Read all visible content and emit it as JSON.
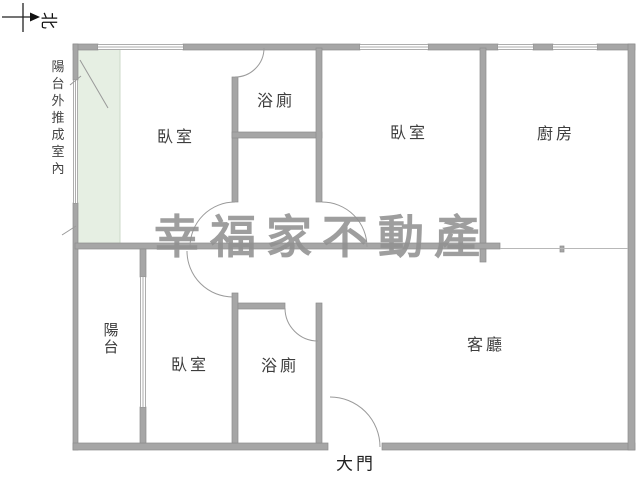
{
  "compass": {
    "north_label": "北"
  },
  "annotation": {
    "text": "陽台外推成室內"
  },
  "watermark": {
    "text": "幸福家不動產",
    "color": "#919191"
  },
  "rooms": {
    "bedroom_top_left": "臥室",
    "bathroom_top": "浴廁",
    "bedroom_top_right": "臥室",
    "kitchen": "廚房",
    "balcony": "陽台",
    "bedroom_bottom": "臥室",
    "bathroom_bottom": "浴廁",
    "living_room": "客廳",
    "main_door": "大門"
  },
  "colors": {
    "wall": "#a6a6a6",
    "wall_edge": "#8d8d8d",
    "green_area": "#e6efe3",
    "door_arc": "#9a9a9a"
  }
}
